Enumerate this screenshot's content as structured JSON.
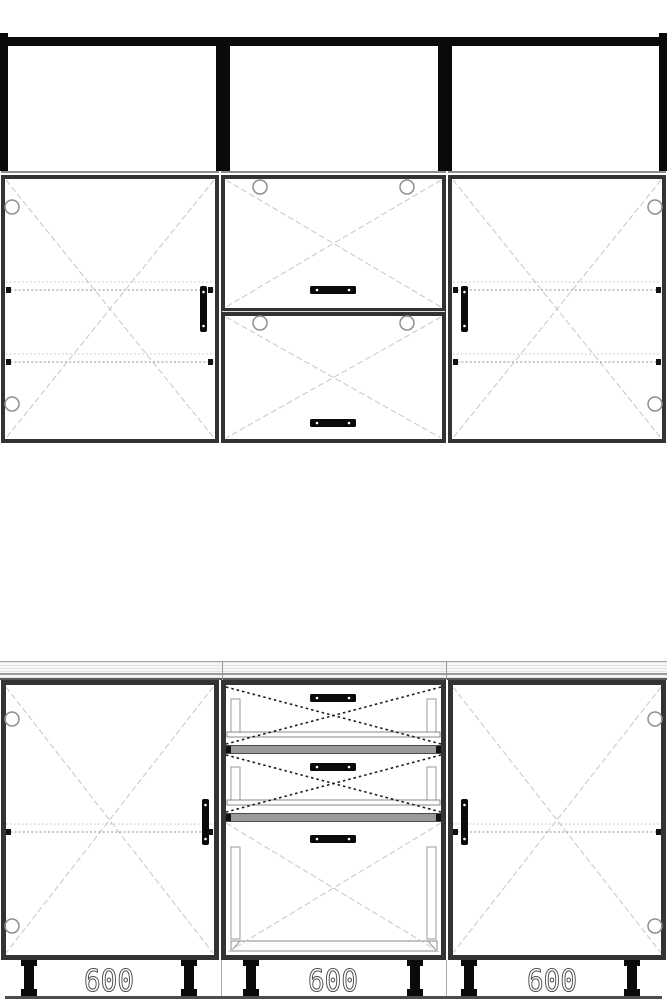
{
  "colors": {
    "frame_black": "#0a0a0a",
    "cabinet_border": "#333333",
    "line_gray": "#8f8f8f",
    "door_cross": "#c6c6c6",
    "drawer_cross": "#1b1b1b",
    "separator": "#9a9a9a",
    "countertop_line": "#9b9b9b",
    "label_outline": "#4a4a4a",
    "floor_shadow": "#4d4d4d"
  },
  "base_units": [
    {
      "position": "left",
      "width_label": "600"
    },
    {
      "position": "middle",
      "width_label": "600"
    },
    {
      "position": "right",
      "width_label": "600"
    }
  ]
}
